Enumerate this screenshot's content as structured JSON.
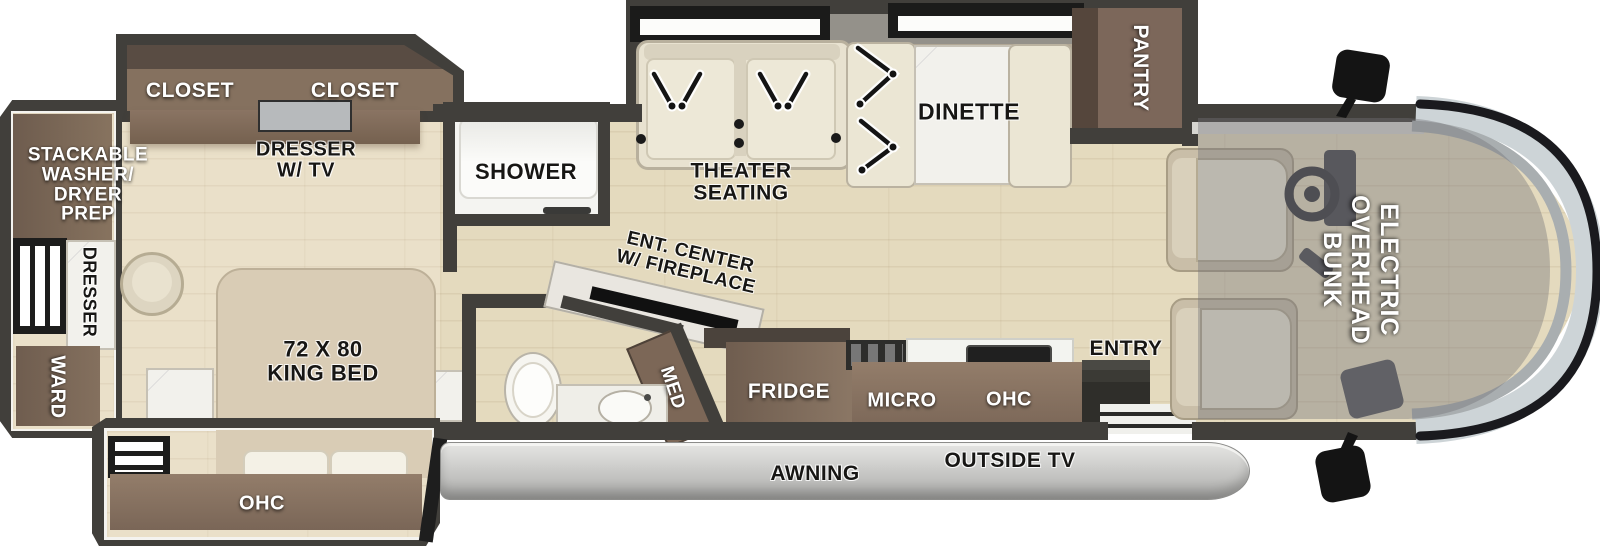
{
  "diagram_type": "rv-motorhome-floorplan",
  "labels": {
    "closet_left": "CLOSET",
    "closet_right": "CLOSET",
    "dresser_tv": "DRESSER\nW/ TV",
    "washer": "STACKABLE\nWASHER/\nDRYER\nPREP",
    "dresser_side": "DRESSER",
    "ward": "WARD",
    "king_bed": "72 X 80\nKING BED",
    "ohc_bed": "OHC",
    "shower": "SHOWER",
    "ent_center": "ENT. CENTER\nW/ FIREPLACE",
    "med": "MED",
    "theater": "THEATER\nSEATING",
    "dinette": "DINETTE",
    "pantry": "PANTRY",
    "fridge": "FRIDGE",
    "micro": "MICRO",
    "ohc_kitchen": "OHC",
    "entry": "ENTRY",
    "awning": "AWNING",
    "outside_tv": "OUTSIDE TV",
    "overhead_bunk": "ELECTRIC\nOVERHEAD\nBUNK"
  },
  "palette": {
    "wall": "#413f3b",
    "floor_wood": "#e4dabe",
    "floor_bedroom": "#eae0c9",
    "cabinet_brown": "#7e6a59",
    "cabinet_dark": "#55463c",
    "seat_cream": "#ebe6d4",
    "marble_white": "#f2f1ec",
    "windshield_glass": "#cdd4d7",
    "awning_gray": "#c4c4c2",
    "bunk_overlay": "rgba(116,116,120,0.40)",
    "label_dark": "#171614",
    "label_light": "#ffffff"
  }
}
